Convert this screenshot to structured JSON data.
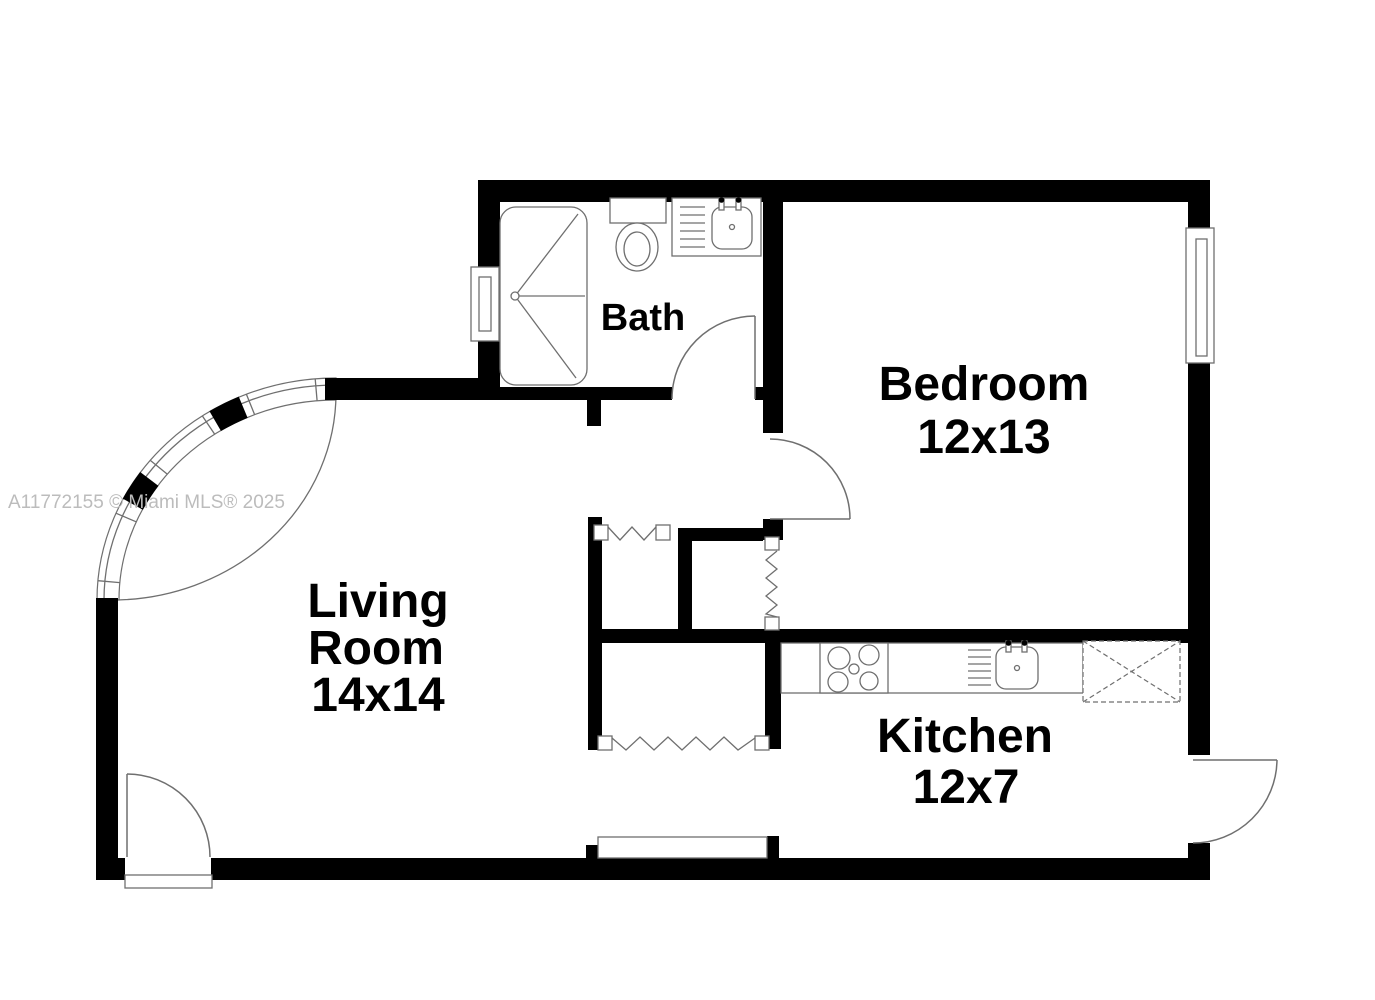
{
  "watermark": {
    "text": "A11772155 © Miami MLS® 2025"
  },
  "colors": {
    "wall": "#000000",
    "line": "#6f6f6f",
    "label": "#000000",
    "watermark": "#bcbcbc",
    "background": "#ffffff"
  },
  "rooms": {
    "bath": {
      "name": "Bath"
    },
    "bedroom": {
      "name": "Bedroom",
      "size": "12x13"
    },
    "living_room": {
      "name_line1": "Living",
      "name_line2": "Room",
      "size": "14x14"
    },
    "kitchen": {
      "name": "Kitchen",
      "size": "12x7"
    }
  },
  "fixtures": {
    "bath": [
      "shower",
      "toilet",
      "sink-vanity"
    ],
    "kitchen": [
      "stove",
      "sink",
      "appliance-space"
    ]
  },
  "doors": [
    "entry-door",
    "bath-door",
    "bedroom-door",
    "kitchen-exterior-door",
    "hall-closet-accordion-door",
    "bedroom-closet-accordion-door",
    "pantry-closet-accordion-door"
  ],
  "windows": [
    "curved-corner-windows",
    "bath-window",
    "bedroom-window"
  ]
}
